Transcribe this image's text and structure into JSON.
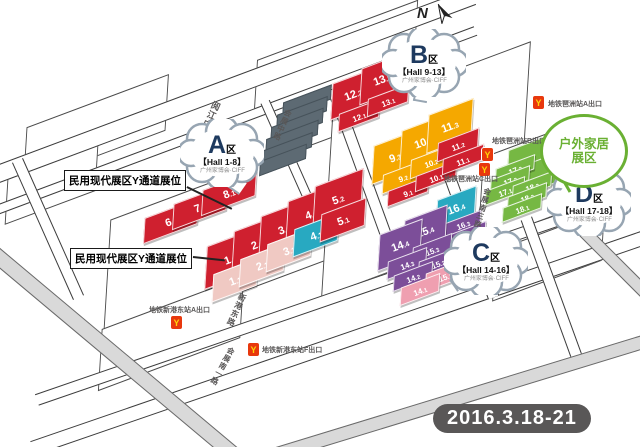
{
  "date_badge": "2016.3.18-21",
  "compass": {
    "label": "N"
  },
  "colors": {
    "red": "#cf202f",
    "pink": "#f0c9c3",
    "teal": "#28a9c1",
    "yellow": "#f5a800",
    "purple": "#7c4e99",
    "rose": "#ef9fb0",
    "green": "#76b843",
    "building_gray": "#5d6a73",
    "road_gray": "#d9d9d9",
    "text_gray": "#595757"
  },
  "bubbles": [
    {
      "id": "A",
      "letter": "A",
      "qu": "区",
      "hall": "【Hall 1-8】",
      "org": "广州家博会·CIFF",
      "x": 222,
      "y": 153,
      "tail": {
        "x": 236,
        "y": 184,
        "rot": 35
      }
    },
    {
      "id": "B",
      "letter": "B",
      "qu": "区",
      "hall": "【Hall 9-13】",
      "org": "广州家博会·CIFF",
      "x": 424,
      "y": 63,
      "tail": {
        "x": 420,
        "y": 94,
        "rot": 10
      }
    },
    {
      "id": "C",
      "letter": "C",
      "qu": "区",
      "hall": "【Hall 14-16】",
      "org": "广州家博会·CIFF",
      "x": 486,
      "y": 261,
      "tail": {
        "x": 458,
        "y": 281,
        "rot": 55
      }
    },
    {
      "id": "D",
      "letter": "D",
      "qu": "区",
      "hall": "【Hall 17-18】",
      "org": "广州家博会·CIFF",
      "x": 589,
      "y": 202,
      "tail": {
        "x": 558,
        "y": 210,
        "rot": 80
      }
    }
  ],
  "outdoor_bubble": {
    "line1": "户外家居",
    "line2": "展区",
    "x": 581,
    "y": 148,
    "w": 82,
    "h": 68,
    "tail": {
      "x": 570,
      "y": 181,
      "rot": 60
    }
  },
  "note_boxes": [
    {
      "text": "民用现代展区Y通道展位",
      "x": 64,
      "y": 170,
      "line": {
        "x": 187,
        "y": 186,
        "len": 50,
        "rot": 26
      }
    },
    {
      "text": "民用现代展区Y通道展位",
      "x": 70,
      "y": 248,
      "line": {
        "x": 193,
        "y": 256,
        "len": 32,
        "rot": 6
      }
    }
  ],
  "street_labels": [
    {
      "name": "阅江中路",
      "x": 203,
      "y": 100,
      "rot": 24,
      "size": 9
    },
    {
      "name": "会展中路",
      "x": 277,
      "y": 108,
      "rot": 24,
      "size": 7.5
    },
    {
      "name": "新港东路",
      "x": 231,
      "y": 292,
      "rot": 24,
      "size": 8
    },
    {
      "name": "会展南一路",
      "x": 217,
      "y": 345,
      "rot": 28,
      "size": 7.5
    },
    {
      "name": "会展南三路",
      "x": 477,
      "y": 187,
      "rot": 16,
      "size": 7.5
    }
  ],
  "metro_exits": [
    {
      "label": "地铁琶洲站A出口",
      "icon": {
        "x": 533,
        "y": 96
      },
      "glyph": "Y",
      "lx": 548,
      "ly": 99
    },
    {
      "label": "地铁琶洲站B出口",
      "icon": {
        "x": 482,
        "y": 148
      },
      "glyph": "Y",
      "lx": 492,
      "ly": 136
    },
    {
      "label": "地铁琶洲站C出口",
      "icon": {
        "x": 479,
        "y": 163
      },
      "glyph": "Y",
      "lx": 444,
      "ly": 174
    },
    {
      "label": "地铁新港东站A出口",
      "icon": {
        "x": 171,
        "y": 316
      },
      "glyph": "Y",
      "lx": 149,
      "ly": 305
    },
    {
      "label": "地铁新港东站F出口",
      "icon": {
        "x": 248,
        "y": 343
      },
      "glyph": "Y",
      "lx": 262,
      "ly": 345
    }
  ],
  "plots": [
    {
      "x": 247,
      "y": 228,
      "w": 300,
      "h": 112
    },
    {
      "x": 425,
      "y": 168,
      "w": 210,
      "h": 165
    },
    {
      "x": 527,
      "y": 182,
      "w": 100,
      "h": 78
    },
    {
      "x": 95,
      "y": 128,
      "w": 150,
      "h": 50
    },
    {
      "x": 50,
      "y": 184,
      "w": 95,
      "h": 40
    },
    {
      "x": 335,
      "y": 55,
      "w": 170,
      "h": 46
    },
    {
      "x": 170,
      "y": 332,
      "w": 150,
      "h": 55
    },
    {
      "x": 547,
      "y": 254,
      "w": 115,
      "h": 45
    }
  ],
  "roads": [
    {
      "x": 220,
      "y": 90,
      "len": 540,
      "wd": 16,
      "rot": -20.5,
      "gray": false
    },
    {
      "x": 232,
      "y": 121,
      "len": 520,
      "wd": 8,
      "rot": -20.5,
      "gray": false
    },
    {
      "x": 330,
      "y": 298,
      "len": 620,
      "wd": 10,
      "rot": -19,
      "gray": false
    },
    {
      "x": 340,
      "y": 341,
      "len": 650,
      "wd": 13,
      "rot": -19,
      "gray": false
    },
    {
      "x": 48,
      "y": 228,
      "len": 150,
      "wd": 10,
      "rot": 66,
      "gray": false
    },
    {
      "x": 290,
      "y": 158,
      "len": 125,
      "wd": 8,
      "rot": 66,
      "gray": false
    },
    {
      "x": 368,
      "y": 186,
      "len": 195,
      "wd": 10,
      "rot": 70,
      "gray": false
    },
    {
      "x": 468,
      "y": 226,
      "len": 150,
      "wd": 10,
      "rot": 70,
      "gray": false
    },
    {
      "x": 552,
      "y": 288,
      "len": 150,
      "wd": 10,
      "rot": 70,
      "gray": false
    },
    {
      "x": 108,
      "y": 348,
      "len": 330,
      "wd": 14,
      "rot": 40,
      "gray": true
    },
    {
      "x": 460,
      "y": 397,
      "len": 430,
      "wd": 12,
      "rot": -17,
      "gray": true
    },
    {
      "x": 616,
      "y": 262,
      "len": 110,
      "wd": 11,
      "rot": 45,
      "gray": true
    }
  ],
  "buildings": [
    {
      "x": 306,
      "y": 100,
      "w": 50,
      "h": 12
    },
    {
      "x": 301,
      "y": 112,
      "w": 52,
      "h": 12
    },
    {
      "x": 296,
      "y": 124,
      "w": 54,
      "h": 12
    },
    {
      "x": 291,
      "y": 136,
      "w": 54,
      "h": 12
    },
    {
      "x": 286,
      "y": 148,
      "w": 52,
      "h": 12
    },
    {
      "x": 282,
      "y": 159,
      "w": 48,
      "h": 12
    }
  ],
  "halls": [
    {
      "label": "6.1",
      "zone": "A",
      "color": "red",
      "x": 170,
      "y": 220,
      "w": 56,
      "h": 22
    },
    {
      "label": "7.1",
      "zone": "A",
      "color": "red",
      "x": 199,
      "y": 206,
      "w": 56,
      "h": 22
    },
    {
      "label": "8.1",
      "zone": "A",
      "color": "red",
      "x": 228,
      "y": 192,
      "w": 56,
      "h": 22
    },
    {
      "label": "1.2",
      "zone": "A",
      "color": "red",
      "x": 229,
      "y": 258,
      "w": 50,
      "h": 38
    },
    {
      "label": "2.2",
      "zone": "A",
      "color": "red",
      "x": 256,
      "y": 243,
      "w": 50,
      "h": 38
    },
    {
      "label": "3.2",
      "zone": "A",
      "color": "red",
      "x": 283,
      "y": 228,
      "w": 50,
      "h": 38
    },
    {
      "label": "4.2",
      "zone": "A",
      "color": "red",
      "x": 310,
      "y": 213,
      "w": 50,
      "h": 38
    },
    {
      "label": "5.2",
      "zone": "A",
      "color": "red",
      "x": 337,
      "y": 198,
      "w": 50,
      "h": 38
    },
    {
      "label": "1.1",
      "zone": "A",
      "color": "pink",
      "x": 234,
      "y": 279,
      "w": 46,
      "h": 24
    },
    {
      "label": "2.1",
      "zone": "A",
      "color": "pink",
      "x": 261,
      "y": 264,
      "w": 46,
      "h": 24
    },
    {
      "label": "3.1",
      "zone": "A",
      "color": "pink",
      "x": 288,
      "y": 249,
      "w": 46,
      "h": 24
    },
    {
      "label": "4.1",
      "zone": "A",
      "color": "teal",
      "x": 315,
      "y": 234,
      "w": 46,
      "h": 24
    },
    {
      "label": "5.1",
      "zone": "A",
      "color": "red",
      "x": 342,
      "y": 219,
      "w": 46,
      "h": 24
    },
    {
      "label": "12.2",
      "zone": "B",
      "color": "red",
      "x": 352,
      "y": 93,
      "w": 44,
      "h": 32
    },
    {
      "label": "13.2",
      "zone": "B",
      "color": "red",
      "x": 381,
      "y": 78,
      "w": 44,
      "h": 32
    },
    {
      "label": "12.1",
      "zone": "B",
      "color": "red",
      "x": 358,
      "y": 114,
      "w": 42,
      "h": 15
    },
    {
      "label": "13.1",
      "zone": "B",
      "color": "red",
      "x": 387,
      "y": 99,
      "w": 42,
      "h": 15
    },
    {
      "label": "9.3",
      "zone": "B",
      "color": "yellow",
      "x": 394,
      "y": 156,
      "w": 46,
      "h": 34
    },
    {
      "label": "10.3",
      "zone": "B",
      "color": "yellow",
      "x": 422,
      "y": 141,
      "w": 46,
      "h": 34
    },
    {
      "label": "11.3",
      "zone": "B",
      "color": "yellow",
      "x": 449,
      "y": 125,
      "w": 46,
      "h": 34
    },
    {
      "label": "9.2",
      "zone": "B",
      "color": "yellow",
      "x": 402,
      "y": 176,
      "w": 42,
      "h": 16
    },
    {
      "label": "10.2",
      "zone": "B",
      "color": "yellow",
      "x": 430,
      "y": 161,
      "w": 42,
      "h": 16
    },
    {
      "label": "11.2",
      "zone": "B",
      "color": "red",
      "x": 457,
      "y": 144,
      "w": 42,
      "h": 16
    },
    {
      "label": "9.1",
      "zone": "B",
      "color": "red",
      "x": 407,
      "y": 190,
      "w": 42,
      "h": 13
    },
    {
      "label": "10.1",
      "zone": "B",
      "color": "red",
      "x": 435,
      "y": 175,
      "w": 42,
      "h": 13
    },
    {
      "label": "11.1",
      "zone": "B",
      "color": "red",
      "x": 462,
      "y": 158,
      "w": 42,
      "h": 13
    },
    {
      "label": "16.4",
      "zone": "C",
      "color": "teal",
      "x": 455,
      "y": 207,
      "w": 40,
      "h": 26
    },
    {
      "label": "16.3",
      "zone": "C",
      "color": "purple",
      "x": 462,
      "y": 223,
      "w": 36,
      "h": 12
    },
    {
      "label": "16.2",
      "zone": "C",
      "color": "purple",
      "x": 467,
      "y": 234,
      "w": 36,
      "h": 12
    },
    {
      "label": "16.1",
      "zone": "C",
      "color": "purple",
      "x": 472,
      "y": 245,
      "w": 36,
      "h": 12
    },
    {
      "label": "15.4",
      "zone": "C",
      "color": "purple",
      "x": 424,
      "y": 230,
      "w": 44,
      "h": 32
    },
    {
      "label": "14.4",
      "zone": "C",
      "color": "purple",
      "x": 399,
      "y": 244,
      "w": 44,
      "h": 32
    },
    {
      "label": "15.3",
      "zone": "C",
      "color": "purple",
      "x": 431,
      "y": 248,
      "w": 40,
      "h": 15
    },
    {
      "label": "14.3",
      "zone": "C",
      "color": "purple",
      "x": 406,
      "y": 262,
      "w": 40,
      "h": 15
    },
    {
      "label": "15.2",
      "zone": "C",
      "color": "purple",
      "x": 437,
      "y": 261,
      "w": 40,
      "h": 13
    },
    {
      "label": "14.2",
      "zone": "C",
      "color": "purple",
      "x": 412,
      "y": 275,
      "w": 40,
      "h": 13
    },
    {
      "label": "15.1",
      "zone": "C",
      "color": "rose",
      "x": 444,
      "y": 274,
      "w": 40,
      "h": 15
    },
    {
      "label": "14.1",
      "zone": "C",
      "color": "rose",
      "x": 419,
      "y": 288,
      "w": 40,
      "h": 15
    },
    {
      "label": "",
      "zone": "D",
      "color": "green",
      "x": 529,
      "y": 156,
      "w": 46,
      "h": 26
    },
    {
      "label": "",
      "zone": "D",
      "color": "green",
      "x": 544,
      "y": 171,
      "w": 46,
      "h": 26
    },
    {
      "label": "17.3",
      "zone": "D",
      "color": "green",
      "x": 514,
      "y": 168,
      "w": 40,
      "h": 12
    },
    {
      "label": "17.2",
      "zone": "D",
      "color": "green",
      "x": 509,
      "y": 179,
      "w": 40,
      "h": 12
    },
    {
      "label": "17.1",
      "zone": "D",
      "color": "green",
      "x": 504,
      "y": 190,
      "w": 40,
      "h": 12
    },
    {
      "label": "18.3",
      "zone": "D",
      "color": "green",
      "x": 531,
      "y": 185,
      "w": 40,
      "h": 12
    },
    {
      "label": "18.2",
      "zone": "D",
      "color": "green",
      "x": 526,
      "y": 196,
      "w": 40,
      "h": 12
    },
    {
      "label": "18.1",
      "zone": "D",
      "color": "green",
      "x": 521,
      "y": 207,
      "w": 40,
      "h": 12
    }
  ]
}
